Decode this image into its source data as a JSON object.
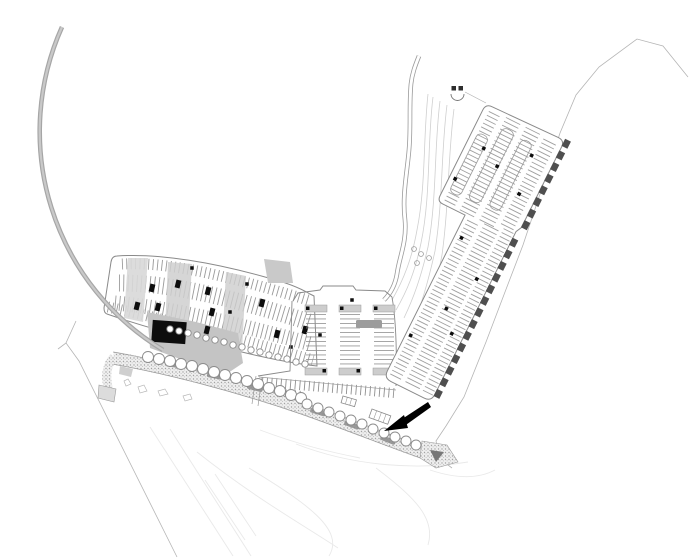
{
  "plan": {
    "kind": "architectural-site-plan",
    "canvas": {
      "width": 696,
      "height": 560,
      "background": "#ffffff"
    },
    "colors": {
      "outline": "#8a8a8a",
      "stall": "#8f8f8f",
      "road_casing": "#9a9a9a",
      "road_core": "#ffffff",
      "arc_road": "#a6a6a6",
      "arc_core": "#c9c9c9",
      "building": "#0d0d0d",
      "plaza": "#c4c4c4",
      "paving_light": "#d8d8d8",
      "paving_mid": "#cdcdcd",
      "cap_fill": "#cdcdcd",
      "tab": "#4f4f4f",
      "boundary": "#b5b5b5",
      "faint": "#e9e9e9",
      "tree_stroke": "#8c8c8c",
      "blob": "#8a8a8a",
      "arrow": "#000000",
      "stipple_bg": "#efefef",
      "stipple_dot": "#a3a3a3"
    },
    "features": [
      {
        "name": "ring-road",
        "kind": "road-arc"
      },
      {
        "name": "north-access-road",
        "kind": "road"
      },
      {
        "name": "gatehouse",
        "kind": "structure"
      },
      {
        "name": "diagonal-parking-lot",
        "kind": "parking"
      },
      {
        "name": "central-parking-lot",
        "kind": "parking"
      },
      {
        "name": "curved-parking-lot",
        "kind": "parking"
      },
      {
        "name": "main-building",
        "kind": "building"
      },
      {
        "name": "promenade",
        "kind": "landscape-band"
      },
      {
        "name": "entrance-arrow",
        "kind": "annotation"
      },
      {
        "name": "site-boundary",
        "kind": "boundary"
      },
      {
        "name": "contour-lines",
        "kind": "terrain"
      }
    ],
    "trees": {
      "upper_r": 5.5,
      "lower_r": 5,
      "scallop_r": 3.2,
      "roadside_r": 2.4,
      "promenade_upper": [
        [
          148,
          357
        ],
        [
          159,
          359
        ],
        [
          170,
          361
        ],
        [
          181,
          364
        ],
        [
          192,
          366
        ],
        [
          203,
          369
        ],
        [
          214,
          372
        ],
        [
          225,
          375
        ],
        [
          236,
          378
        ],
        [
          247,
          381
        ],
        [
          258,
          384
        ],
        [
          269,
          388
        ],
        [
          280,
          391
        ],
        [
          291,
          395
        ],
        [
          301,
          398
        ]
      ],
      "promenade_lower": [
        [
          307,
          404
        ],
        [
          318,
          408
        ],
        [
          329,
          412
        ],
        [
          340,
          416
        ],
        [
          351,
          420
        ],
        [
          362,
          424
        ],
        [
          373,
          429
        ],
        [
          384,
          433
        ],
        [
          395,
          437
        ],
        [
          406,
          441
        ],
        [
          416,
          445
        ]
      ],
      "parking_scallops": [
        [
          170,
          329
        ],
        [
          179,
          331
        ],
        [
          188,
          333
        ],
        [
          197,
          335
        ],
        [
          206,
          338
        ],
        [
          215,
          340
        ],
        [
          224,
          342
        ],
        [
          233,
          345
        ],
        [
          242,
          347
        ],
        [
          251,
          350
        ],
        [
          260,
          352
        ],
        [
          269,
          355
        ],
        [
          278,
          357
        ],
        [
          287,
          359
        ],
        [
          296,
          362
        ],
        [
          305,
          364
        ]
      ],
      "roadside_small": [
        [
          414,
          249
        ],
        [
          421,
          254
        ],
        [
          429,
          258
        ],
        [
          417,
          263
        ]
      ]
    },
    "diagonal_lot": {
      "band_tabs": {
        "count": 14,
        "start_x": 6,
        "step": 13,
        "y": 25.5,
        "w": 8,
        "h": 6.5
      },
      "cluster_tabs": {
        "count": 8,
        "start_x": 196,
        "step": 13,
        "y": 28.5,
        "w": 8,
        "h": 6.5
      },
      "dots": [
        [
          50,
          -22
        ],
        [
          90,
          -2
        ],
        [
          130,
          12
        ],
        [
          160,
          -20
        ],
        [
          70,
          14
        ],
        [
          210,
          -52
        ],
        [
          240,
          -20
        ],
        [
          265,
          6
        ],
        [
          225,
          12
        ],
        [
          250,
          -40
        ]
      ]
    },
    "central_lot": {
      "columns": [
        316,
        350,
        384
      ],
      "column_top_y": 314,
      "column_bot_y": 368
    },
    "curved_lot": {
      "black_islands": [
        [
          152,
          288
        ],
        [
          137,
          306
        ],
        [
          158,
          307
        ],
        [
          178,
          284
        ],
        [
          208,
          291
        ],
        [
          212,
          312
        ],
        [
          262,
          303
        ],
        [
          277,
          334
        ],
        [
          305,
          330
        ],
        [
          207,
          330
        ]
      ],
      "tiny_squares": [
        [
          192,
          268
        ],
        [
          247,
          284
        ],
        [
          230,
          312
        ],
        [
          320,
          335
        ],
        [
          291,
          347
        ],
        [
          352,
          300
        ]
      ]
    },
    "promenade": {
      "blobs": [
        [
          175,
          365,
          9
        ],
        [
          215,
          376,
          11
        ],
        [
          255,
          388,
          14
        ],
        [
          318,
          412,
          17
        ],
        [
          352,
          425,
          19
        ],
        [
          388,
          440,
          21
        ]
      ]
    }
  }
}
